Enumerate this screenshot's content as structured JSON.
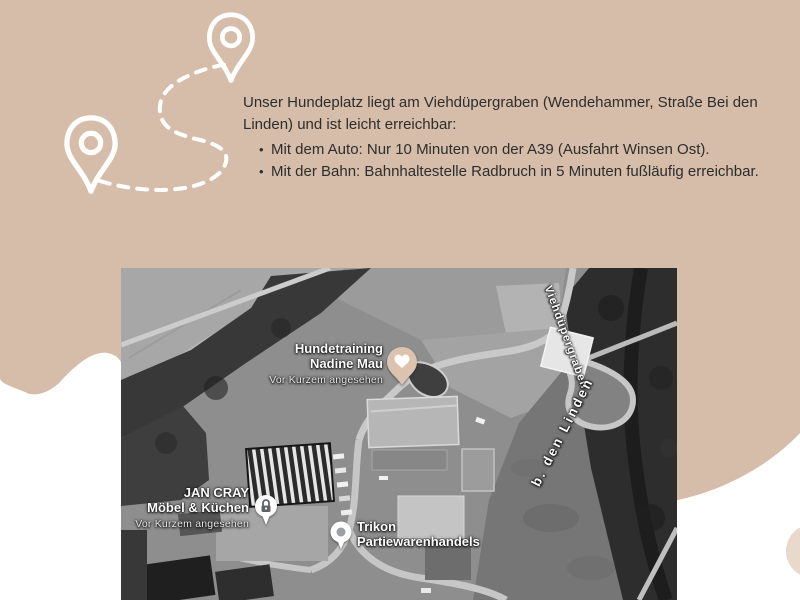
{
  "colors": {
    "blob": "#d5bda9",
    "accent_circle": "#e9d9cb",
    "heart_pin_fill": "#dcc3b0",
    "heart_pin_heart": "#ffffff"
  },
  "intro": {
    "paragraph": "Unser Hundeplatz liegt am Viehdüpergraben (Wendehammer, Straße Bei den Linden) und ist leicht erreichbar:",
    "bullets": [
      "Mit dem Auto: Nur 10 Minuten von der A39 (Ausfahrt Winsen Ost).",
      "Mit der Bahn: Bahnhaltestelle Radbruch in 5 Minuten fußläufig erreichbar."
    ]
  },
  "map": {
    "markers": {
      "hundetraining": {
        "line1": "Hundetraining",
        "line2": "Nadine Mau",
        "status": "Vor Kurzem angesehen"
      },
      "jancray": {
        "line1": "JAN CRAY",
        "line2": "Möbel & Küchen",
        "status": "Vor Kurzem angesehen"
      },
      "trikon": {
        "line1": "Trikon",
        "line2": "Partiewarenhandels"
      }
    },
    "street_labels": {
      "viehduepergraben": "Viehdüpergraben",
      "bdenlinden": "b. den Linden"
    }
  }
}
